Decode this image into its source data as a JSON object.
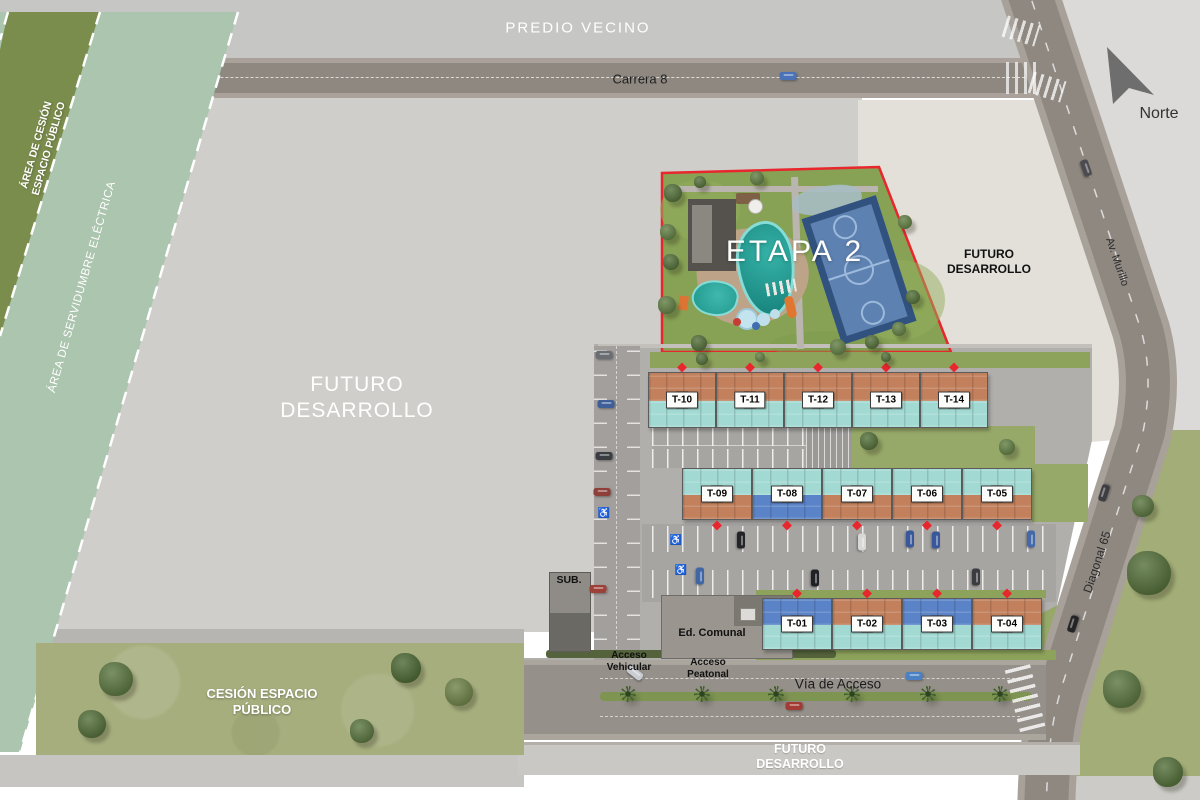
{
  "colors": {
    "terracotta": "#c2805c",
    "aqua": "#a2dad3",
    "blue": "#5b83c8",
    "marker_red": "#e8262d",
    "etapa_border_red": "#e8262d",
    "grass_dark": "#7b8d4c",
    "grass_sage": "#abc5ae",
    "grass_olive": "#a6ae7e",
    "grass_right": "#a2ad77",
    "grass_etapa": "#87a254",
    "road_asphalt": "#8e8881",
    "site_asphalt": "#b1afac",
    "pad_gray": "#cfcecb",
    "beige": "#e3e0d9",
    "pool_teal": "#1f968d",
    "court_blue": "#5d81b0"
  },
  "zones": {
    "predio_vecino": "PREDIO VECINO",
    "futuro_line1": "FUTURO",
    "futuro_line2": "DESARROLLO",
    "area_cesion_line1": "ÁREA DE CESIÓN",
    "area_cesion_line2": "ESPACIO  PÚBLICO",
    "servidumbre": "ÁREA DE SERVIDUMBRE  ELÉCTRICA",
    "cesion_line1": "CESIÓN ESPACIO",
    "cesion_line2": "PÚBLICO",
    "etapa2": "ETAPA 2"
  },
  "roads": {
    "carrera_8": "Carrera 8",
    "av_murillo": "Av. Murillo",
    "diagonal_65": "Diagonal 65",
    "via_acceso": "Vía de Acceso"
  },
  "north": {
    "label": "Norte"
  },
  "buildings": {
    "sub": "SUB.",
    "ed_comunal": "Ed. Comunal"
  },
  "access": {
    "vehicular_line1": "Acceso",
    "vehicular_line2": "Vehicular",
    "peatonal_line1": "Acceso",
    "peatonal_line2": "Peatonal"
  },
  "misc": {
    "accessibility_glyph": "♿"
  },
  "towers": [
    {
      "id": "T-10",
      "x": 648,
      "y": 372,
      "w": 68,
      "h": 56,
      "top": "terracotta",
      "bottom": "aqua",
      "marker": "top"
    },
    {
      "id": "T-11",
      "x": 716,
      "y": 372,
      "w": 68,
      "h": 56,
      "top": "terracotta",
      "bottom": "aqua",
      "marker": "top"
    },
    {
      "id": "T-12",
      "x": 784,
      "y": 372,
      "w": 68,
      "h": 56,
      "top": "terracotta",
      "bottom": "aqua",
      "marker": "top"
    },
    {
      "id": "T-13",
      "x": 852,
      "y": 372,
      "w": 68,
      "h": 56,
      "top": "terracotta",
      "bottom": "aqua",
      "marker": "top"
    },
    {
      "id": "T-14",
      "x": 920,
      "y": 372,
      "w": 68,
      "h": 56,
      "top": "terracotta",
      "bottom": "aqua",
      "marker": "top"
    },
    {
      "id": "T-09",
      "x": 682,
      "y": 468,
      "w": 70,
      "h": 52,
      "top": "aqua",
      "bottom": "terracotta",
      "marker": "bottom"
    },
    {
      "id": "T-08",
      "x": 752,
      "y": 468,
      "w": 70,
      "h": 52,
      "top": "aqua",
      "bottom": "blue",
      "marker": "bottom"
    },
    {
      "id": "T-07",
      "x": 822,
      "y": 468,
      "w": 70,
      "h": 52,
      "top": "aqua",
      "bottom": "terracotta",
      "marker": "bottom"
    },
    {
      "id": "T-06",
      "x": 892,
      "y": 468,
      "w": 70,
      "h": 52,
      "top": "aqua",
      "bottom": "terracotta",
      "marker": "bottom"
    },
    {
      "id": "T-05",
      "x": 962,
      "y": 468,
      "w": 70,
      "h": 52,
      "top": "aqua",
      "bottom": "terracotta",
      "marker": "bottom"
    },
    {
      "id": "T-01",
      "x": 762,
      "y": 598,
      "w": 70,
      "h": 52,
      "top": "blue",
      "bottom": "aqua",
      "marker": "top"
    },
    {
      "id": "T-02",
      "x": 832,
      "y": 598,
      "w": 70,
      "h": 52,
      "top": "terracotta",
      "bottom": "aqua",
      "marker": "top"
    },
    {
      "id": "T-03",
      "x": 902,
      "y": 598,
      "w": 70,
      "h": 52,
      "top": "blue",
      "bottom": "aqua",
      "marker": "top"
    },
    {
      "id": "T-04",
      "x": 972,
      "y": 598,
      "w": 70,
      "h": 52,
      "top": "terracotta",
      "bottom": "aqua",
      "marker": "top"
    }
  ],
  "cars": [
    {
      "x": 788,
      "y": 76,
      "c": "#4a72b8",
      "a": 0
    },
    {
      "x": 1086,
      "y": 168,
      "c": "#4c4c50",
      "a": 71
    },
    {
      "x": 1104,
      "y": 493,
      "c": "#3e3e42",
      "a": -72
    },
    {
      "x": 1073,
      "y": 624,
      "c": "#242426",
      "a": -72
    },
    {
      "x": 635,
      "y": 673,
      "c": "#c9ccd1",
      "a": 38
    },
    {
      "x": 914,
      "y": 676,
      "c": "#4a80c4",
      "a": 0
    },
    {
      "x": 794,
      "y": 706,
      "c": "#a33b34",
      "a": 0
    },
    {
      "x": 604,
      "y": 355,
      "c": "#6a6e73",
      "a": 0
    },
    {
      "x": 606,
      "y": 404,
      "c": "#3f5f99",
      "a": 0
    },
    {
      "x": 604,
      "y": 456,
      "c": "#3a3d42",
      "a": 0
    },
    {
      "x": 602,
      "y": 492,
      "c": "#8e3f3a",
      "a": 0
    },
    {
      "x": 598,
      "y": 589,
      "c": "#9c4038",
      "a": 0
    },
    {
      "x": 741,
      "y": 540,
      "c": "#232528",
      "a": 90
    },
    {
      "x": 862,
      "y": 542,
      "c": "#d8d8d6",
      "a": 90
    },
    {
      "x": 910,
      "y": 539,
      "c": "#39589c",
      "a": 90
    },
    {
      "x": 936,
      "y": 540,
      "c": "#39589c",
      "a": 90
    },
    {
      "x": 1031,
      "y": 539,
      "c": "#4468a8",
      "a": 90
    },
    {
      "x": 700,
      "y": 576,
      "c": "#4066a6",
      "a": 90
    },
    {
      "x": 815,
      "y": 578,
      "c": "#1f2124",
      "a": 90
    },
    {
      "x": 976,
      "y": 577,
      "c": "#3a3c40",
      "a": 90
    }
  ],
  "trees": [
    {
      "x": 673,
      "y": 193,
      "r": 9,
      "c": "#4e6a33"
    },
    {
      "x": 668,
      "y": 232,
      "r": 8,
      "c": "#5d7a3e"
    },
    {
      "x": 671,
      "y": 262,
      "r": 8,
      "c": "#4e6a33"
    },
    {
      "x": 667,
      "y": 305,
      "r": 9,
      "c": "#5d7a3e"
    },
    {
      "x": 699,
      "y": 343,
      "r": 8,
      "c": "#4e6a33"
    },
    {
      "x": 838,
      "y": 347,
      "r": 8,
      "c": "#5d7a3e"
    },
    {
      "x": 872,
      "y": 342,
      "r": 7,
      "c": "#4e6a33"
    },
    {
      "x": 899,
      "y": 329,
      "r": 7,
      "c": "#5d7a3e"
    },
    {
      "x": 913,
      "y": 297,
      "r": 7,
      "c": "#4e6a33"
    },
    {
      "x": 905,
      "y": 222,
      "r": 7,
      "c": "#5d7a3e"
    },
    {
      "x": 700,
      "y": 182,
      "r": 6,
      "c": "#4e6a33"
    },
    {
      "x": 757,
      "y": 178,
      "r": 7,
      "c": "#5d7a3e"
    },
    {
      "x": 869,
      "y": 441,
      "r": 9,
      "c": "#4e6a33"
    },
    {
      "x": 1007,
      "y": 447,
      "r": 8,
      "c": "#5d7a3e"
    },
    {
      "x": 702,
      "y": 359,
      "r": 6,
      "c": "#4e6a33"
    },
    {
      "x": 760,
      "y": 357,
      "r": 5,
      "c": "#5d7a3e"
    },
    {
      "x": 886,
      "y": 357,
      "r": 5,
      "c": "#4e6a33"
    },
    {
      "x": 1149,
      "y": 573,
      "r": 22,
      "c": "#4e6a33"
    },
    {
      "x": 1122,
      "y": 689,
      "r": 19,
      "c": "#55713a"
    },
    {
      "x": 1168,
      "y": 772,
      "r": 15,
      "c": "#4e6a33"
    },
    {
      "x": 1143,
      "y": 506,
      "r": 11,
      "c": "#55713a"
    },
    {
      "x": 116,
      "y": 679,
      "r": 17,
      "c": "#55713a"
    },
    {
      "x": 92,
      "y": 724,
      "r": 14,
      "c": "#4e6a33"
    },
    {
      "x": 406,
      "y": 668,
      "r": 15,
      "c": "#46632d"
    },
    {
      "x": 459,
      "y": 692,
      "r": 14,
      "c": "#6a7f42"
    },
    {
      "x": 362,
      "y": 731,
      "r": 12,
      "c": "#55713a"
    }
  ],
  "palms": [
    {
      "x": 628,
      "y": 694
    },
    {
      "x": 702,
      "y": 694
    },
    {
      "x": 776,
      "y": 694
    },
    {
      "x": 852,
      "y": 694
    },
    {
      "x": 928,
      "y": 694
    },
    {
      "x": 1000,
      "y": 694
    }
  ],
  "accessibility_spots": [
    {
      "x": 676,
      "y": 541
    },
    {
      "x": 604,
      "y": 514
    },
    {
      "x": 681,
      "y": 571
    }
  ]
}
